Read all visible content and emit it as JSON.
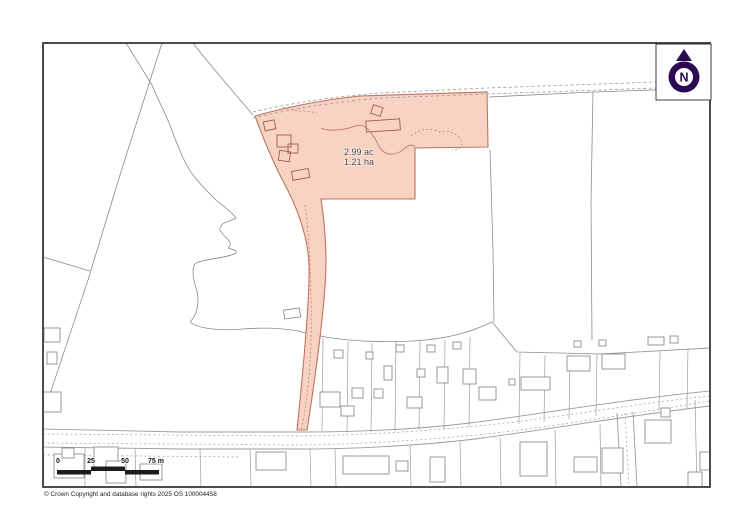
{
  "map": {
    "parcel": {
      "area_acres": "2.99 ac",
      "area_hectares": "1.21 ha"
    },
    "north_indicator": {
      "label": "N"
    },
    "scale_bar": {
      "tick_0": "0",
      "tick_25": "25",
      "tick_50": "50",
      "tick_75": "75 m"
    },
    "copyright": "© Crown Copyright and database rights 2025 OS 100004458"
  },
  "colors": {
    "parcel_fill": "#f8d3c4",
    "parcel_stroke": "#c0735d",
    "boundary_gray": "#8a8a8a",
    "north_purple": "#2b0a54",
    "scalebar_black": "#1c1c1c"
  }
}
